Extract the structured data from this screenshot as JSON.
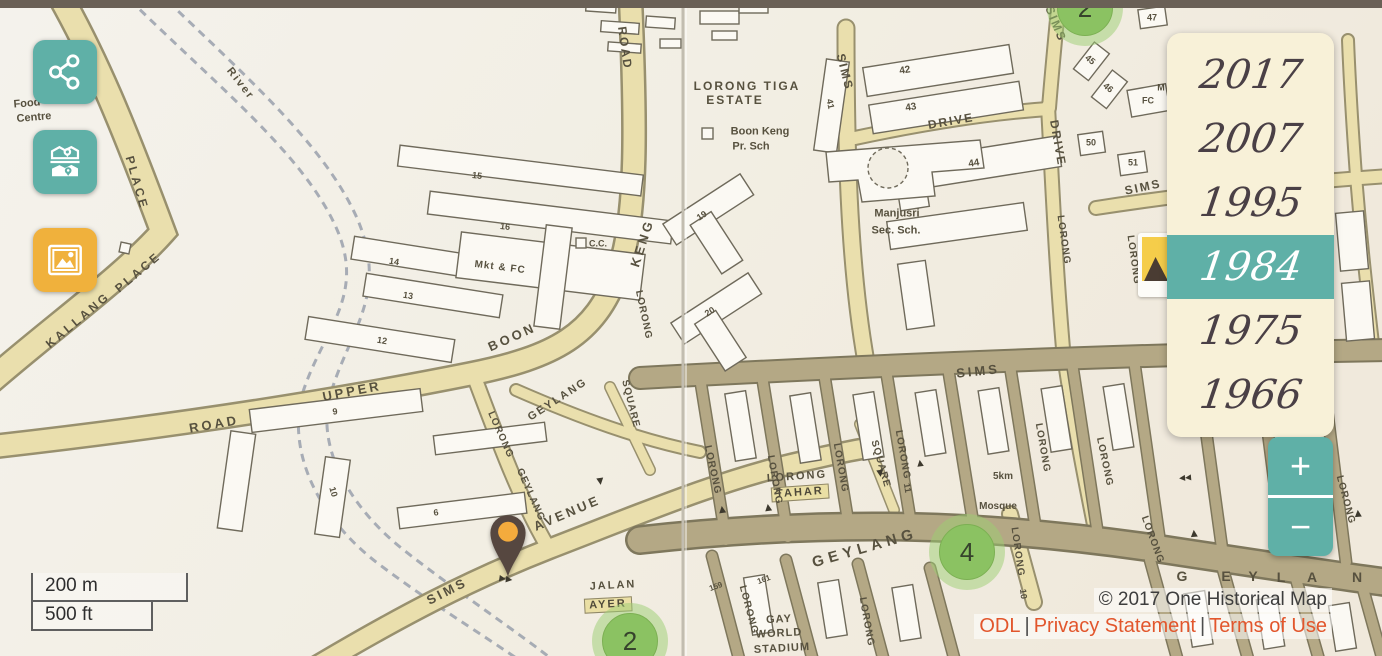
{
  "app_title": "One Historical Map",
  "toolbar": {
    "buttons": [
      {
        "name": "share",
        "icon": "share-icon",
        "color": "#5fb0a7"
      },
      {
        "name": "compare-maps",
        "icon": "map-photo-compare-icon",
        "color": "#5fb0a7"
      },
      {
        "name": "photos",
        "icon": "image-icon",
        "color": "#f0b13c"
      }
    ]
  },
  "years": {
    "items": [
      {
        "label": "2017",
        "selected": false
      },
      {
        "label": "2007",
        "selected": false
      },
      {
        "label": "1995",
        "selected": false
      },
      {
        "label": "1984",
        "selected": true
      },
      {
        "label": "1975",
        "selected": false
      },
      {
        "label": "1966",
        "selected": false
      }
    ]
  },
  "zoom_control": {
    "zoom_in": "+",
    "zoom_out": "−"
  },
  "scale_control": {
    "metric": "200 m",
    "imperial": "500 ft"
  },
  "attribution": {
    "copyright": "© 2017 One Historical Map",
    "links": [
      "ODL",
      "Privacy Statement",
      "Terms of Use"
    ],
    "separator": "|"
  },
  "colors": {
    "teal_accent": "#5fb0a7",
    "yellow_accent": "#f0b13c",
    "panel_cream": "#f8f1d8",
    "selected_year_bg": "#5fb0a7",
    "link_orange": "#e2562c",
    "marker_green": "#8bc262",
    "pin_body_brown": "#564740",
    "pin_dot_orange": "#f4ab3d",
    "top_bar": "#6a6056"
  },
  "map": {
    "markers": [
      {
        "value": "2",
        "x": 1085,
        "y": 8
      },
      {
        "value": "4",
        "x": 967,
        "y": 552
      },
      {
        "value": "2",
        "x": 630,
        "y": 641
      }
    ],
    "labels": [
      {
        "text": "Food",
        "x": 27,
        "y": 104,
        "rot": -5,
        "size": 11
      },
      {
        "text": "Centre",
        "x": 34,
        "y": 118,
        "rot": -5,
        "size": 11
      },
      {
        "text": "River",
        "x": 240,
        "y": 84,
        "rot": 52,
        "size": 11,
        "ls": 2
      },
      {
        "text": "PLACE",
        "x": 137,
        "y": 183,
        "rot": 74,
        "size": 12,
        "ls": 3
      },
      {
        "text": "KALLANG",
        "x": 78,
        "y": 320,
        "rot": -40,
        "size": 12,
        "ls": 3
      },
      {
        "text": "PLACE",
        "x": 138,
        "y": 272,
        "rot": -40,
        "size": 12,
        "ls": 3
      },
      {
        "text": "ROAD",
        "x": 214,
        "y": 424,
        "rot": -10,
        "size": 13,
        "ls": 3
      },
      {
        "text": "UPPER",
        "x": 352,
        "y": 391,
        "rot": -11,
        "size": 13,
        "ls": 3
      },
      {
        "text": "BOON",
        "x": 512,
        "y": 337,
        "rot": -24,
        "size": 13,
        "ls": 3
      },
      {
        "text": "KENG",
        "x": 642,
        "y": 243,
        "rot": -72,
        "size": 13,
        "ls": 3
      },
      {
        "text": "ROAD",
        "x": 625,
        "y": 48,
        "rot": 82,
        "size": 12,
        "ls": 2
      },
      {
        "text": "LORONG",
        "x": 643,
        "y": 315,
        "rot": 78,
        "size": 10,
        "ls": 1
      },
      {
        "text": "LORONG",
        "x": 500,
        "y": 435,
        "rot": 66,
        "size": 10,
        "ls": 1
      },
      {
        "text": "GEYLANG",
        "x": 530,
        "y": 495,
        "rot": 66,
        "size": 10,
        "ls": 1
      },
      {
        "text": "GEYLANG",
        "x": 558,
        "y": 400,
        "rot": -33,
        "size": 11,
        "ls": 2
      },
      {
        "text": "SQUARE",
        "x": 630,
        "y": 404,
        "rot": 76,
        "size": 10,
        "ls": 1
      },
      {
        "text": "SQUARE",
        "x": 880,
        "y": 464,
        "rot": 74,
        "size": 10,
        "ls": 1
      },
      {
        "text": "AVENUE",
        "x": 567,
        "y": 513,
        "rot": -23,
        "size": 13,
        "ls": 3
      },
      {
        "text": "SIMS",
        "x": 447,
        "y": 591,
        "rot": -27,
        "size": 13,
        "ls": 3
      },
      {
        "text": "SIMS",
        "x": 978,
        "y": 371,
        "rot": -6,
        "size": 13,
        "ls": 3
      },
      {
        "text": "SIMS",
        "x": 845,
        "y": 72,
        "rot": 76,
        "size": 12,
        "ls": 2
      },
      {
        "text": "SIMS",
        "x": 1056,
        "y": 24,
        "rot": 68,
        "size": 12,
        "ls": 2
      },
      {
        "text": "SIMS",
        "x": 1143,
        "y": 187,
        "rot": -12,
        "size": 12,
        "ls": 2
      },
      {
        "text": "DRIVE",
        "x": 951,
        "y": 121,
        "rot": -10,
        "size": 12,
        "ls": 2
      },
      {
        "text": "DRIVE",
        "x": 1058,
        "y": 143,
        "rot": 80,
        "size": 12,
        "ls": 2
      },
      {
        "text": "LORONG",
        "x": 1063,
        "y": 240,
        "rot": 82,
        "size": 10,
        "ls": 1
      },
      {
        "text": "LORONG",
        "x": 1133,
        "y": 260,
        "rot": 82,
        "size": 10,
        "ls": 1
      },
      {
        "text": "LORONG TIGA",
        "x": 747,
        "y": 86,
        "size": 12,
        "ls": 2
      },
      {
        "text": "ESTATE",
        "x": 735,
        "y": 100,
        "size": 12,
        "ls": 2
      },
      {
        "text": "Boon Keng",
        "x": 760,
        "y": 132,
        "size": 11
      },
      {
        "text": "Pr. Sch",
        "x": 751,
        "y": 147,
        "size": 11
      },
      {
        "text": "Manjusri",
        "x": 897,
        "y": 214,
        "size": 11
      },
      {
        "text": "Sec. Sch.",
        "x": 896,
        "y": 231,
        "size": 11
      },
      {
        "text": "Mkt & FC",
        "x": 500,
        "y": 268,
        "rot": 7,
        "size": 10,
        "ls": 1
      },
      {
        "text": "C.C.",
        "x": 598,
        "y": 244,
        "size": 9
      },
      {
        "text": "15",
        "x": 477,
        "y": 176,
        "rot": 7,
        "size": 9
      },
      {
        "text": "16",
        "x": 505,
        "y": 227,
        "rot": 7,
        "size": 9
      },
      {
        "text": "14",
        "x": 394,
        "y": 262,
        "rot": 9,
        "size": 9
      },
      {
        "text": "13",
        "x": 408,
        "y": 296,
        "rot": 9,
        "size": 9
      },
      {
        "text": "12",
        "x": 382,
        "y": 341,
        "rot": 9,
        "size": 9
      },
      {
        "text": "9",
        "x": 335,
        "y": 412,
        "rot": -7,
        "size": 9
      },
      {
        "text": "10",
        "x": 333,
        "y": 492,
        "rot": 74,
        "size": 9
      },
      {
        "text": "6",
        "x": 436,
        "y": 513,
        "rot": -7,
        "size": 9
      },
      {
        "text": "19",
        "x": 702,
        "y": 216,
        "rot": -33,
        "size": 9
      },
      {
        "text": "20",
        "x": 710,
        "y": 312,
        "rot": -33,
        "size": 9
      },
      {
        "text": "41",
        "x": 830,
        "y": 104,
        "rot": 78,
        "size": 9
      },
      {
        "text": "42",
        "x": 905,
        "y": 71,
        "rot": -9,
        "size": 10
      },
      {
        "text": "43",
        "x": 911,
        "y": 108,
        "rot": -9,
        "size": 10
      },
      {
        "text": "44",
        "x": 974,
        "y": 164,
        "rot": -9,
        "size": 10
      },
      {
        "text": "50",
        "x": 1091,
        "y": 143,
        "size": 9
      },
      {
        "text": "51",
        "x": 1133,
        "y": 163,
        "size": 9
      },
      {
        "text": "47",
        "x": 1152,
        "y": 18,
        "size": 9
      },
      {
        "text": "45",
        "x": 1090,
        "y": 60,
        "rot": 40,
        "size": 9
      },
      {
        "text": "46",
        "x": 1108,
        "y": 88,
        "rot": 40,
        "size": 9
      },
      {
        "text": "M",
        "x": 1161,
        "y": 88,
        "size": 9
      },
      {
        "text": "FC",
        "x": 1148,
        "y": 101,
        "size": 9
      },
      {
        "text": "LORONG",
        "x": 797,
        "y": 477,
        "rot": -4,
        "size": 11,
        "ls": 2
      },
      {
        "text": "TAHAR",
        "x": 800,
        "y": 493,
        "rot": -4,
        "size": 11,
        "ls": 2,
        "cls": "plate"
      },
      {
        "text": "JALAN",
        "x": 613,
        "y": 586,
        "rot": -3,
        "size": 11,
        "ls": 2
      },
      {
        "text": "AYER",
        "x": 608,
        "y": 605,
        "rot": -3,
        "size": 11,
        "ls": 2,
        "cls": "plate"
      },
      {
        "text": "GEYLANG",
        "x": 865,
        "y": 548,
        "rot": -16,
        "size": 15,
        "ls": 5
      },
      {
        "text": "G",
        "x": 1182,
        "y": 576,
        "size": 14
      },
      {
        "text": "E",
        "x": 1226,
        "y": 576,
        "size": 14
      },
      {
        "text": "Y",
        "x": 1253,
        "y": 576,
        "size": 14
      },
      {
        "text": "L",
        "x": 1281,
        "y": 577,
        "size": 14
      },
      {
        "text": "A",
        "x": 1312,
        "y": 577,
        "size": 14
      },
      {
        "text": "N",
        "x": 1357,
        "y": 577,
        "size": 14
      },
      {
        "text": "Mosque",
        "x": 998,
        "y": 507,
        "size": 10
      },
      {
        "text": "5km",
        "x": 1003,
        "y": 477,
        "size": 10
      },
      {
        "text": "GAY",
        "x": 779,
        "y": 620,
        "rot": -3,
        "size": 11,
        "ls": 1
      },
      {
        "text": "WORLD",
        "x": 779,
        "y": 634,
        "rot": -3,
        "size": 11,
        "ls": 1
      },
      {
        "text": "STADIUM",
        "x": 782,
        "y": 649,
        "rot": -3,
        "size": 11,
        "ls": 1
      },
      {
        "text": "LORONG",
        "x": 712,
        "y": 470,
        "rot": 78,
        "size": 10,
        "ls": 1
      },
      {
        "text": "LORONG",
        "x": 774,
        "y": 480,
        "rot": 80,
        "size": 10,
        "ls": 1
      },
      {
        "text": "LORONG",
        "x": 840,
        "y": 468,
        "rot": 80,
        "size": 10,
        "ls": 1
      },
      {
        "text": "LORONG",
        "x": 902,
        "y": 455,
        "rot": 80,
        "size": 10,
        "ls": 1
      },
      {
        "text": "11",
        "x": 907,
        "y": 488,
        "rot": 80,
        "size": 9
      },
      {
        "text": "LORONG",
        "x": 1042,
        "y": 448,
        "rot": 80,
        "size": 10,
        "ls": 1
      },
      {
        "text": "LORONG",
        "x": 1104,
        "y": 462,
        "rot": 78,
        "size": 10,
        "ls": 1
      },
      {
        "text": "LORONG",
        "x": 1152,
        "y": 540,
        "rot": 70,
        "size": 10,
        "ls": 1
      },
      {
        "text": "LORONG",
        "x": 1345,
        "y": 500,
        "rot": 75,
        "size": 10,
        "ls": 1
      },
      {
        "text": "LORONG",
        "x": 748,
        "y": 610,
        "rot": 75,
        "size": 10,
        "ls": 1
      },
      {
        "text": "LORONG",
        "x": 866,
        "y": 622,
        "rot": 80,
        "size": 10,
        "ls": 1
      },
      {
        "text": "LORONG",
        "x": 1017,
        "y": 552,
        "rot": 82,
        "size": 10,
        "ls": 1
      },
      {
        "text": "10",
        "x": 1023,
        "y": 594,
        "rot": 82,
        "size": 9
      },
      {
        "text": "159",
        "x": 716,
        "y": 587,
        "rot": -20,
        "size": 8
      },
      {
        "text": "161",
        "x": 764,
        "y": 580,
        "rot": -20,
        "size": 8
      },
      {
        "text": "▸▸",
        "x": 506,
        "y": 578,
        "rot": 8,
        "size": 13,
        "cls": "arrow"
      },
      {
        "text": "▴",
        "x": 722,
        "y": 508,
        "rot": -8,
        "size": 14,
        "cls": "arrow"
      },
      {
        "text": "▴",
        "x": 768,
        "y": 506,
        "rot": -8,
        "size": 14,
        "cls": "arrow"
      },
      {
        "text": "▾",
        "x": 880,
        "y": 472,
        "rot": -8,
        "size": 14,
        "cls": "arrow"
      },
      {
        "text": "▴",
        "x": 920,
        "y": 462,
        "rot": -8,
        "size": 13,
        "cls": "arrow"
      },
      {
        "text": "▾",
        "x": 600,
        "y": 480,
        "rot": -8,
        "size": 14,
        "cls": "arrow"
      },
      {
        "text": "▴",
        "x": 1194,
        "y": 532,
        "rot": -5,
        "size": 14,
        "cls": "arrow"
      },
      {
        "text": "▴",
        "x": 1358,
        "y": 512,
        "rot": -5,
        "size": 14,
        "cls": "arrow"
      },
      {
        "text": "◂◂",
        "x": 1185,
        "y": 477,
        "rot": -5,
        "size": 12,
        "cls": "arrow"
      }
    ]
  }
}
